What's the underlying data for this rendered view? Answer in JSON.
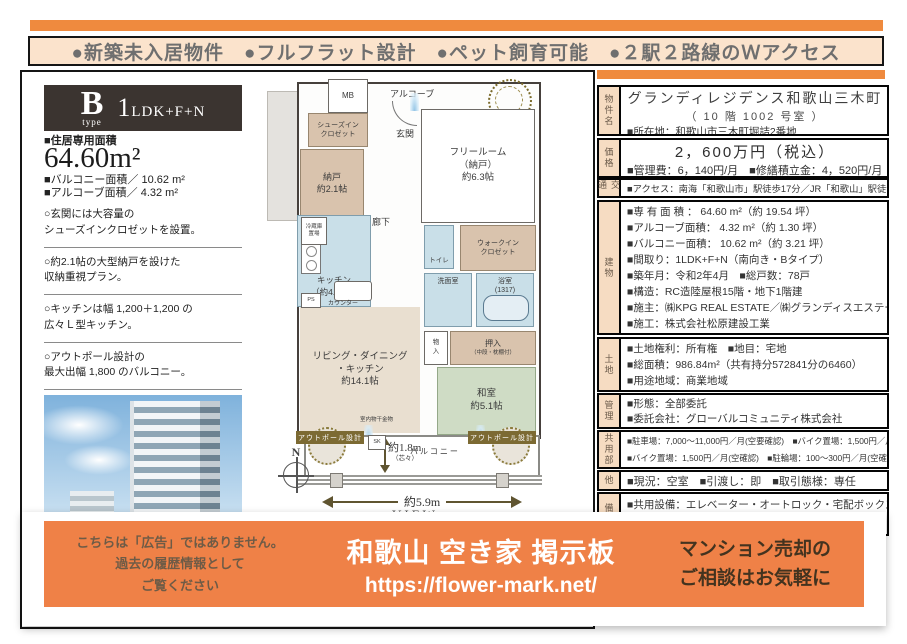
{
  "top_banner": {
    "text": "●新築未入居物件　●フルフラット設計　●ペット飼育可能　●２駅２路線のＷアクセス"
  },
  "left_panel": {
    "type_letter": "B",
    "type_word": "type",
    "plan_num": "1",
    "plan_rest": "LDK+F+N",
    "area_label": "■住居専用面積",
    "area_value": "64.60m²",
    "balcony_line": "■バルコニー面積／ 10.62 m²",
    "alcove_line": "■アルコーブ面積／ 4.32 m²",
    "features": [
      "○玄関には大容量の\nシューズインクロゼットを設置。",
      "○約2.1帖の大型納戸を設けた\n収納重視プラン。",
      "○キッチンは幅 1,200＋1,200 の\n広々Ｌ型キッチン。",
      "○アウトポール設計の\n最大出幅 1,800 のバルコニー。",
      "○ウォークインクロゼットを備えた\n約6.3帖のフリールーム（納戸）。"
    ]
  },
  "floor_plan": {
    "mb": "MB",
    "alcove": "アルコーブ",
    "entrance": "玄関",
    "shoes_closet": "シューズイン\nクロゼット",
    "storage": "納戸\n約2.1帖",
    "free_room": "フリールーム\n（納戸）\n約6.3帖",
    "hallway": "廊下",
    "fridge": "冷蔵庫\n置場",
    "kitchen": "キッチン\n（約4.1帖）",
    "toilet": "トイレ",
    "wic": "ウォークイン\nクロゼット",
    "washroom": "洗面室",
    "bath": "浴室\n(1317)",
    "storage_small": "物\n入",
    "oshiire": "押入",
    "oshiire_sub": "（中段・枕棚付）",
    "ldk": "リビング・ダイニング\n・キッチン\n約14.1帖",
    "washitsu": "和室\n約5.1帖",
    "counter": "カウンター",
    "ps": "PS",
    "sk": "SK",
    "laundry": "室内物干金物",
    "balcony": "バルコニー",
    "outpole": "アウトポール設計",
    "depth": "約1.8m",
    "depth_sub": "（芯々）",
    "width": "約5.9m",
    "view": "VIEW",
    "north": "N"
  },
  "right_panel": {
    "sections": [
      {
        "label": "物件名",
        "title": "グランディレジデンス和歌山三木町",
        "sub": "（ 10 階 1002 号室 ）",
        "rows": [
          "■所在地：和歌山市三木町堀詰2番地"
        ]
      },
      {
        "label": "価格",
        "title": "2，600万円（税込）",
        "rows": [
          "■管理費：6，140円/月　■修繕積立金：4，520円/月"
        ]
      },
      {
        "label": "交通",
        "rows": [
          "■アクセス：南海「和歌山市」駅徒歩17分／JR「和歌山」駅徒歩18分"
        ]
      },
      {
        "label": "建物",
        "rows": [
          "■専 有 面 積 ： 64.60 m²（約 19.54 坪）",
          "■アルコーブ面積：  4.32 m²（約  1.30 坪）",
          "■バルコニー面積： 10.62 m²（約  3.21 坪）",
          "■間取り：1LDK+F+N（南向き・Bタイプ）",
          "■築年月：令和2年4月　■総戸数：78戸",
          "■構造：RC造陸屋根15階・地下1階建",
          "■施主：㈱KPG REAL ESTATE／㈱グランディスエステート",
          "■施工：株式会社松原建設工業"
        ]
      },
      {
        "label": "土地",
        "rows": [
          "■土地権利：所有権　■地目：宅地",
          "■総面積：986.84m²（共有持分572841分の6460）",
          "■用途地域：商業地域"
        ]
      },
      {
        "label": "管理",
        "rows": [
          "■形態：全部委託",
          "■委託会社：グローバルコミュニティ株式会社"
        ]
      },
      {
        "label": "共用部",
        "rows": [
          "■駐車場：7,000～11,000円／月(空要確認)　■バイク置場：1,500円／月(空確認)",
          "■バイク置場：1,500円／月(空確認)　■駐輪場：100～300円／月(空確認)"
        ]
      },
      {
        "label": "他",
        "rows": [
          "■現況：空室　■引渡し：即　■取引態様：専任"
        ]
      },
      {
        "label": "備考",
        "rows": [
          "■共用設備：エレベーター・オートロック・宅配ボックス"
        ]
      }
    ]
  },
  "bottom_banner": {
    "left_note": "こちらは「広告」ではありません。\n過去の履歴情報として\nご覧ください",
    "title": "和歌山 空き家 掲示板",
    "url": "https://flower-mark.net/",
    "right_note": "マンション売却の\nご相談はお気軽に"
  },
  "colors": {
    "orange": "#ef8a3e",
    "banner_bg": "#fbe3cc",
    "badge_bg": "#3b3430",
    "label_bg": "#f6dcc2"
  }
}
